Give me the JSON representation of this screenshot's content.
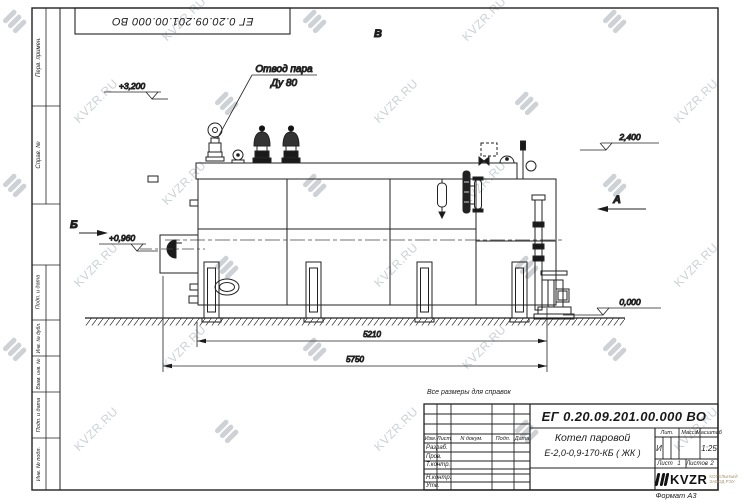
{
  "watermark": {
    "text": "KVZR.RU"
  },
  "frame": {
    "top_stamp": "ЕГ 0.20.09.201.00.000  ВО",
    "format_label": "Формат  А3",
    "margin_labels": [
      "Перв. примен.",
      "Справ. №",
      "Подп. и дата",
      "Инв. № дубл.",
      "Взам. инв. №",
      "Подп. и дата",
      "Инв. № подл."
    ]
  },
  "note": "Все размеры для справок",
  "annotations": {
    "steam_outlet": {
      "line1": "Отвод пара",
      "line2": "Ду 80"
    },
    "elev_top": "+3,200",
    "elev_right": "2,400",
    "elev_burner": "+0,960",
    "elev_ground": "0,000",
    "view_top": "В",
    "view_right": "А",
    "section_left": "Б",
    "dim_inner": "5210",
    "dim_overall": "5750"
  },
  "title_block": {
    "designation": "ЕГ 0.20.09.201.00.000  ВО",
    "col_izm": "Изм.",
    "col_list": "Лист",
    "col_ndoc": "N докум.",
    "col_podp": "Подп.",
    "col_data": "Дата",
    "row_razrab": "Разраб.",
    "row_prov": "Пров.",
    "row_tkontr": "Т.контр.",
    "row_nkontr": "Н.контр.",
    "row_utv": "Утв.",
    "product_line1": "Котел паровой",
    "product_line2": "Е-2,0-0,9-170-КБ ( ЖК )",
    "lit_header": "Лит.",
    "mass_header": "Масса",
    "scale_header": "Масштаб",
    "lit_value": "И",
    "scale_value": "1:25",
    "sheet_label": "Лист",
    "sheet_value": "1",
    "sheets_label": "Листов",
    "sheets_value": "2",
    "logo_text": "KVZR",
    "logo_sub_line1": "КОТЕЛЬНЫЙ",
    "logo_sub_line2": "ЗАВОД РЭУ"
  }
}
